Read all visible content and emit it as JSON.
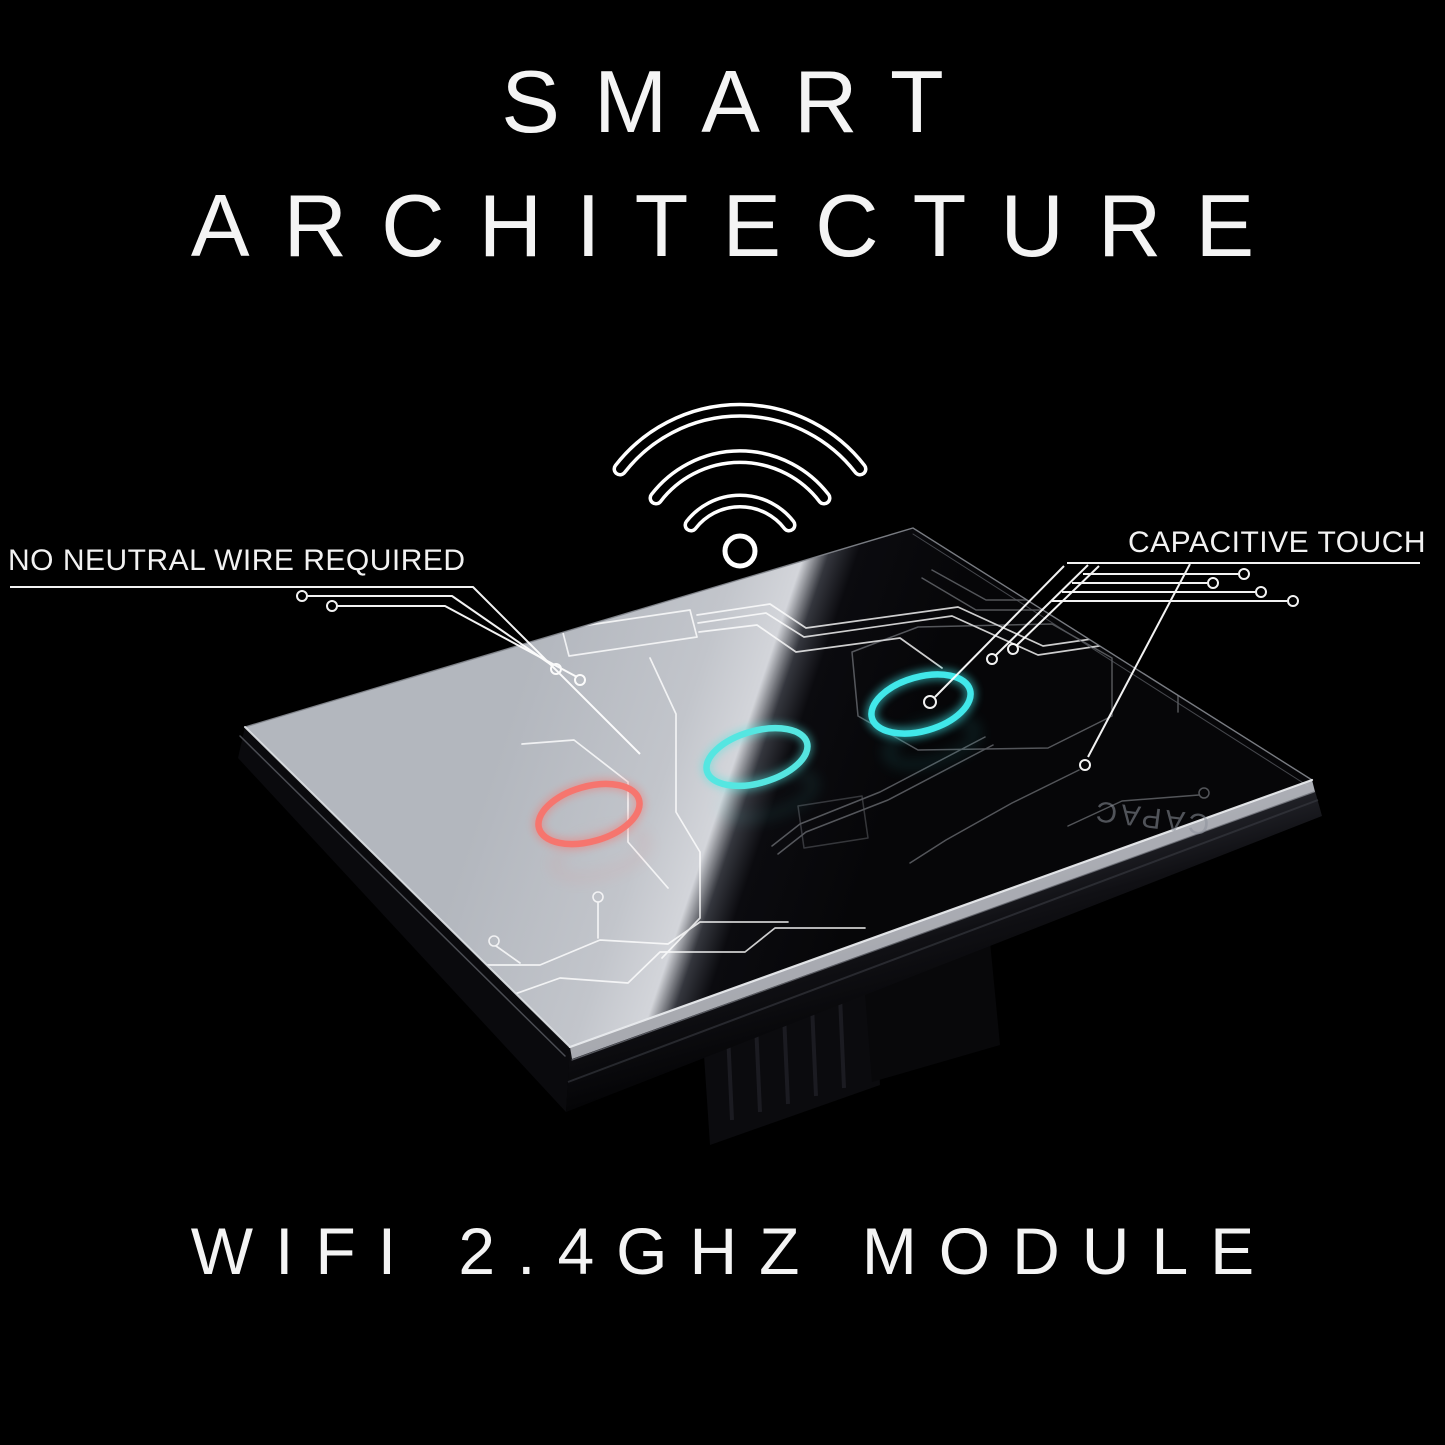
{
  "title": {
    "line1": "SMART",
    "line2": "ARCHITECTURE"
  },
  "callouts": {
    "left": "NO NEUTRAL WIRE REQUIRED",
    "right": "CAPACITIVE TOUCH",
    "reflection": "CAPAC"
  },
  "footer": {
    "text": "WIFI 2.4GHZ MODULE"
  },
  "device": {
    "background": "#000000",
    "text_color": "#f4f4f4",
    "trace_color": "#ffffff",
    "icons": {
      "wifi": "wifi-icon"
    },
    "rings": [
      {
        "name": "touch-ring-red",
        "color": "#f6756e"
      },
      {
        "name": "touch-ring-teal-center",
        "color": "#55e6e1"
      },
      {
        "name": "touch-ring-teal-right",
        "color": "#41e8ea"
      }
    ]
  }
}
